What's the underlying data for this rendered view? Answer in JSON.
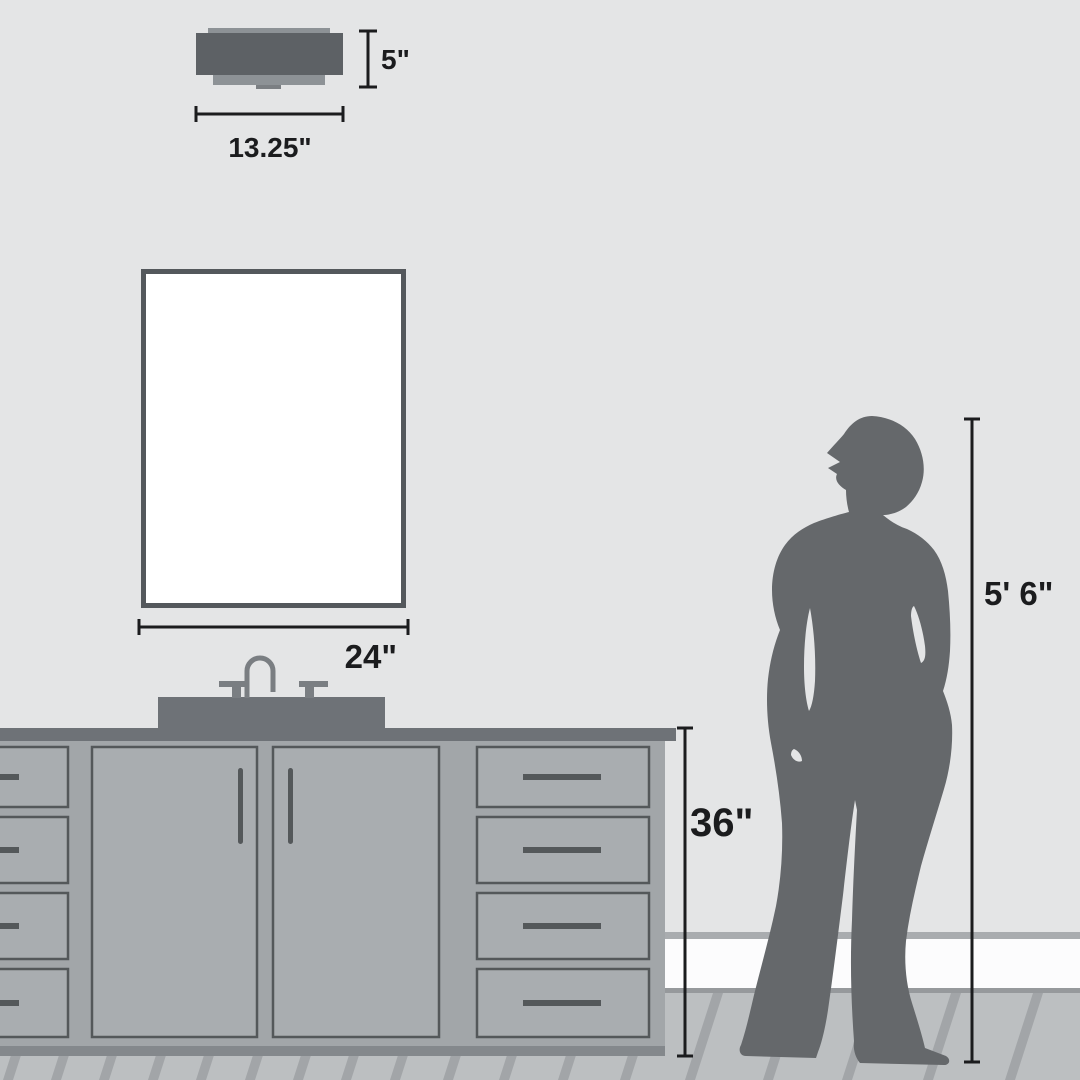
{
  "scene": {
    "type": "product-size-comparison-diagram",
    "annotations": {
      "fixture_height": "5\"",
      "fixture_width": "13.25\"",
      "mirror_width": "24\"",
      "vanity_height": "36\"",
      "person_height": "5' 6\""
    }
  },
  "colors": {
    "wall": "#e4e5e6",
    "ink": "#1b1c1e",
    "fixture-dark": "#5d6165",
    "fixture-light": "#8d9296",
    "fixture-tab": "#7b7f83",
    "mirror-frame": "#54585c",
    "mirror-glass": "#ffffff",
    "counter": "#6e7277",
    "cabinet": "#a2a6a9",
    "panel": "#a9adb0",
    "panel-outline": "#54585a",
    "handle": "#54585a",
    "base": "#84888c",
    "faucet": "#7a7e82",
    "person": "#65686b",
    "baseboard-trim": "#a9acaf",
    "baseboard": "#fcfcfd",
    "floor-edge": "#96999c",
    "floor": "#bcbfc1",
    "floor-stripe": "#a2a5a8"
  }
}
